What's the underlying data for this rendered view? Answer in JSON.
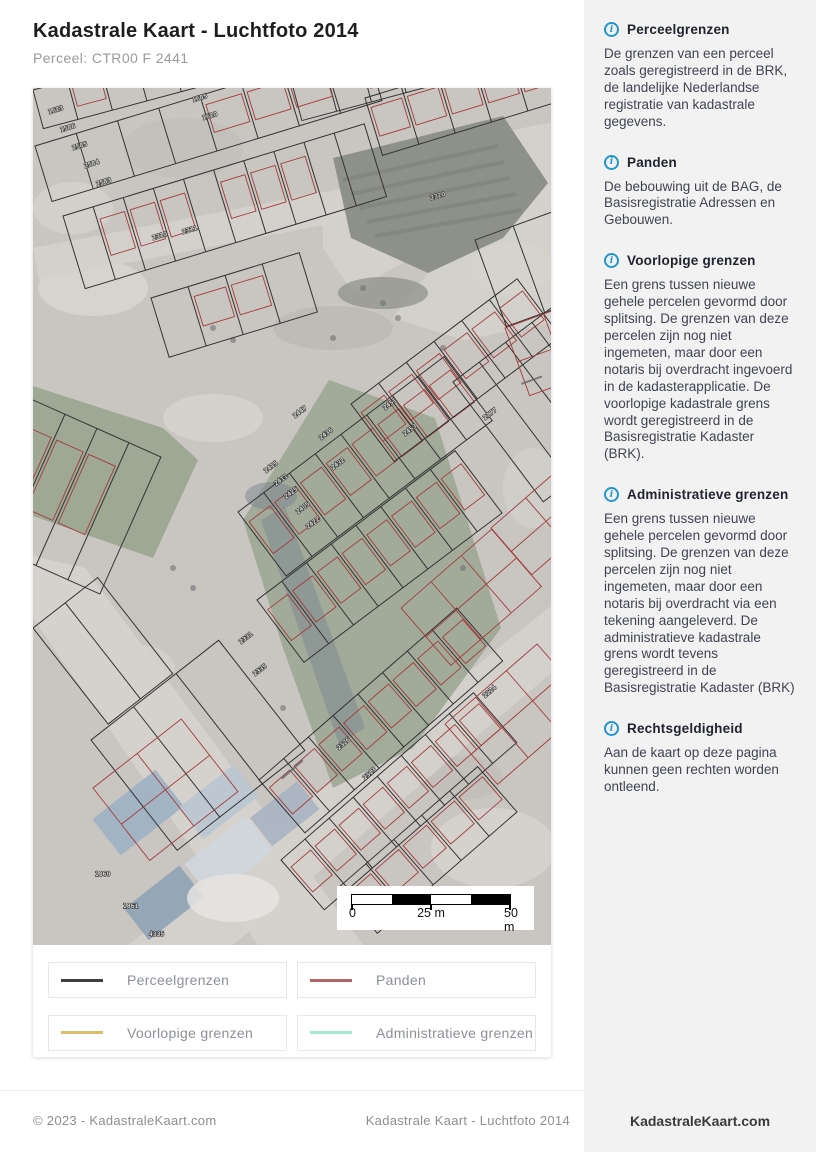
{
  "header": {
    "title": "Kadastrale Kaart - Luchtfoto 2014",
    "subtitle": "Perceel: CTR00 F 2441"
  },
  "sidebar": {
    "info_icon_glyph": "i",
    "sections": [
      {
        "title": "Perceelgrenzen",
        "body": "De grenzen van een perceel zoals geregistreerd in de BRK, de landelijke Nederlandse registratie van kadastrale gegevens."
      },
      {
        "title": "Panden",
        "body": "De bebouwing uit de BAG, de Basisregistratie Adressen en Gebouwen."
      },
      {
        "title": "Voorlopige grenzen",
        "body": "Een grens tussen nieuwe gehele percelen gevormd door splitsing. De grenzen van deze percelen zijn nog niet ingemeten, maar door een notaris bij overdracht ingevoerd in de kadasterapplicatie. De voorlopige kadastrale grens wordt geregistreerd in de Basisregistratie Kadaster (BRK)."
      },
      {
        "title": "Administratieve grenzen",
        "body": "Een grens tussen nieuwe gehele percelen gevormd door splitsing. De grenzen van deze percelen zijn nog niet ingemeten, maar door een notaris bij overdracht via een tekening aangeleverd. De administratieve kadastrale grens wordt tevens geregistreerd in de Basisregistratie Kadaster (BRK)"
      },
      {
        "title": "Rechtsgeldigheid",
        "body": "Aan de kaart op deze pagina kunnen geen rechten worden ontleend."
      }
    ]
  },
  "legend": {
    "items": [
      {
        "label": "Perceelgrenzen",
        "color": "#3f3f3f"
      },
      {
        "label": "Panden",
        "color": "#b36666"
      },
      {
        "label": "Voorlopige grenzen",
        "color": "#d9bc6c"
      },
      {
        "label": "Administratieve grenzen",
        "color": "#a6e9d2"
      }
    ]
  },
  "map": {
    "scale": {
      "zero": "0",
      "mid": "25 m",
      "end": "50 m"
    },
    "colors": {
      "ground": "#c9c6c1",
      "road": "#d5d2cd",
      "vegetation": "#a0aa97",
      "pit": "#8e9189",
      "parcel_line": "#333333",
      "pand_line": "#a23b3b",
      "roof": "#9db0c3",
      "shadow": "#76808d"
    },
    "parcel_labels": [
      {
        "t": "1623",
        "x": 16,
        "y": 26,
        "r": -17
      },
      {
        "t": "1586",
        "x": 28,
        "y": 44,
        "r": -17
      },
      {
        "t": "2585",
        "x": 40,
        "y": 62,
        "r": -17
      },
      {
        "t": "2584",
        "x": 52,
        "y": 80,
        "r": -17
      },
      {
        "t": "2583",
        "x": 64,
        "y": 98,
        "r": -17
      },
      {
        "t": "1685",
        "x": 160,
        "y": 14,
        "r": -17
      },
      {
        "t": "1620",
        "x": 170,
        "y": 32,
        "r": -17
      },
      {
        "t": "2320",
        "x": 398,
        "y": 112,
        "r": -17
      },
      {
        "t": "2310",
        "x": 120,
        "y": 152,
        "r": -17
      },
      {
        "t": "2311",
        "x": 150,
        "y": 146,
        "r": -17
      },
      {
        "t": "2447",
        "x": 262,
        "y": 330,
        "r": -37
      },
      {
        "t": "2436",
        "x": 288,
        "y": 352,
        "r": -37
      },
      {
        "t": "2432",
        "x": 300,
        "y": 382,
        "r": -37
      },
      {
        "t": "2415",
        "x": 233,
        "y": 385,
        "r": -37
      },
      {
        "t": "2411",
        "x": 243,
        "y": 398,
        "r": -37
      },
      {
        "t": "2425",
        "x": 253,
        "y": 411,
        "r": -37
      },
      {
        "t": "2405",
        "x": 265,
        "y": 426,
        "r": -37
      },
      {
        "t": "2422",
        "x": 275,
        "y": 441,
        "r": -37
      },
      {
        "t": "2451",
        "x": 352,
        "y": 322,
        "r": -37
      },
      {
        "t": "2453",
        "x": 372,
        "y": 348,
        "r": -37
      },
      {
        "t": "2177",
        "x": 452,
        "y": 332,
        "r": -37
      },
      {
        "t": "2331",
        "x": 208,
        "y": 556,
        "r": -37
      },
      {
        "t": "2335",
        "x": 222,
        "y": 588,
        "r": -37
      },
      {
        "t": "2326",
        "x": 306,
        "y": 662,
        "r": -41
      },
      {
        "t": "2313",
        "x": 332,
        "y": 692,
        "r": -41
      },
      {
        "t": "2224",
        "x": 452,
        "y": 610,
        "r": -41
      },
      {
        "t": "1860",
        "x": 62,
        "y": 788,
        "r": 0
      },
      {
        "t": "1861",
        "x": 90,
        "y": 820,
        "r": 0
      },
      {
        "t": "4335",
        "x": 116,
        "y": 848,
        "r": 0
      }
    ]
  },
  "footer": {
    "copyright": "© 2023 - KadastraleKaart.com",
    "page_title": "Kadastrale Kaart - Luchtfoto 2014",
    "brand": "KadastraleKaart.com"
  }
}
